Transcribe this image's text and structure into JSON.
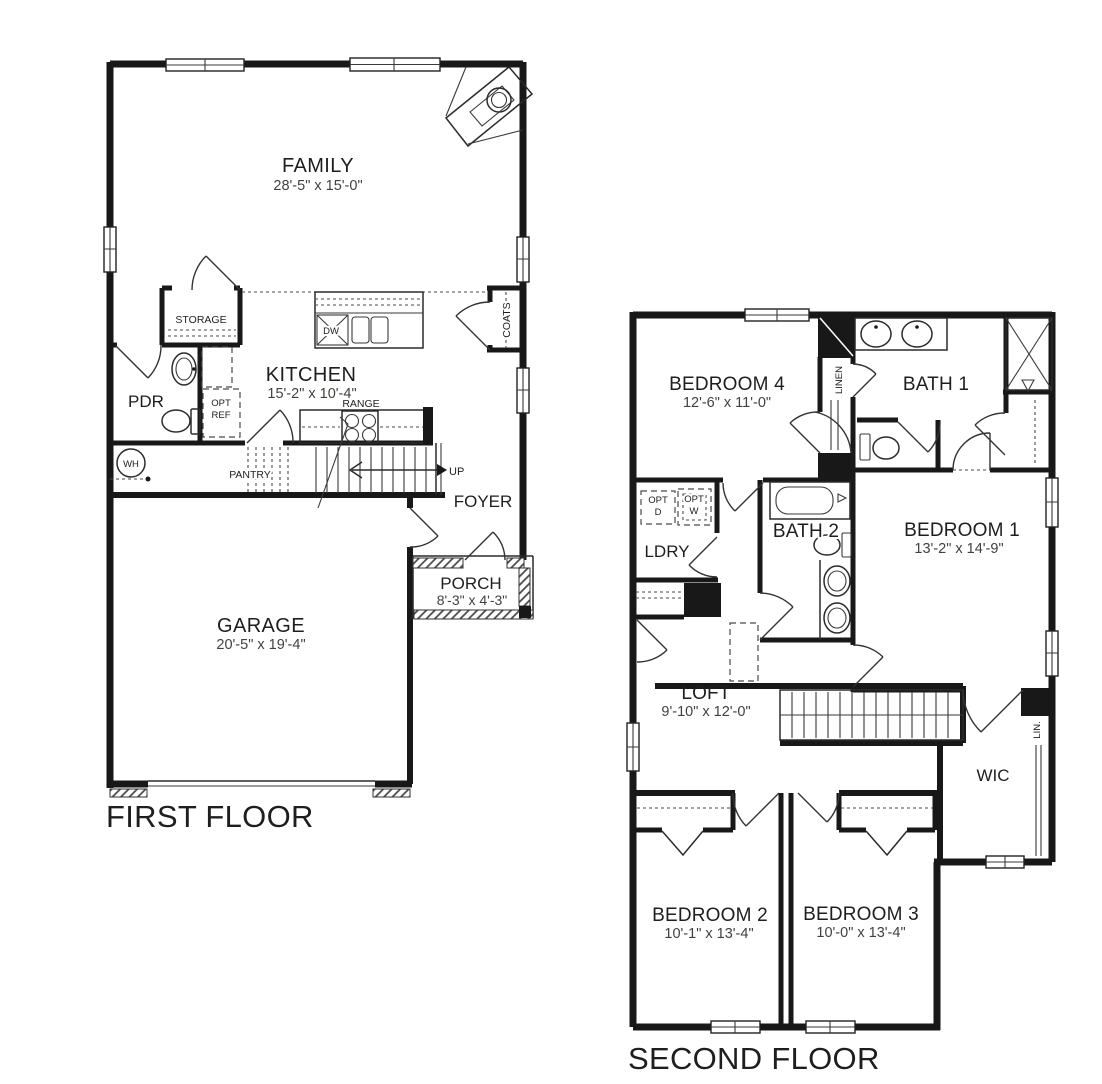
{
  "first_floor": {
    "title": "FIRST FLOOR",
    "rooms": {
      "family": {
        "name": "FAMILY",
        "dims": "28'-5\" x 15'-0\""
      },
      "kitchen": {
        "name": "KITCHEN",
        "dims": "15'-2\" x 10'-4\""
      },
      "garage": {
        "name": "GARAGE",
        "dims": "20'-5\" x 19'-4\""
      },
      "porch": {
        "name": "PORCH",
        "dims": "8'-3\" x 4'-3\""
      },
      "foyer": {
        "name": "FOYER"
      },
      "pdr": {
        "name": "PDR"
      }
    },
    "labels": {
      "storage": "STORAGE",
      "pantry": "PANTRY",
      "coats": "COATS",
      "range": "RANGE",
      "dw": "DW",
      "wh": "WH",
      "up": "UP",
      "opt_ref_line1": "OPT",
      "opt_ref_line2": "REF"
    }
  },
  "second_floor": {
    "title": "SECOND FLOOR",
    "rooms": {
      "bedroom1": {
        "name": "BEDROOM 1",
        "dims": "13'-2\" x 14'-9\""
      },
      "bedroom2": {
        "name": "BEDROOM 2",
        "dims": "10'-1\" x 13'-4\""
      },
      "bedroom3": {
        "name": "BEDROOM 3",
        "dims": "10'-0\" x 13'-4\""
      },
      "bedroom4": {
        "name": "BEDROOM 4",
        "dims": "12'-6\" x 11'-0\""
      },
      "loft": {
        "name": "LOFT",
        "dims": "9'-10\" x 12'-0\""
      },
      "bath1": {
        "name": "BATH 1"
      },
      "bath2": {
        "name": "BATH 2"
      },
      "ldry": {
        "name": "LDRY"
      },
      "wic": {
        "name": "WIC"
      }
    },
    "labels": {
      "linen": "LINEN",
      "lin": "LIN.",
      "opt_d_line1": "OPT",
      "opt_d_line2": "D",
      "opt_w_line1": "OPT",
      "opt_w_line2": "W"
    }
  }
}
